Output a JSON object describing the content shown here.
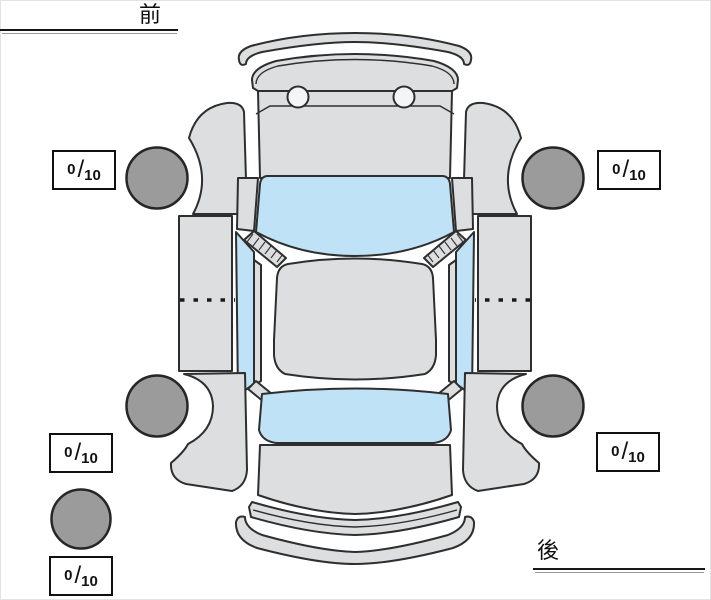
{
  "labels": {
    "front": "前",
    "rear": "後"
  },
  "scores": {
    "separator": "/",
    "front_left": {
      "value": "0",
      "max": "10"
    },
    "front_right": {
      "value": "0",
      "max": "10"
    },
    "rear_left": {
      "value": "0",
      "max": "10"
    },
    "rear_right": {
      "value": "0",
      "max": "10"
    },
    "spare": {
      "value": "0",
      "max": "10"
    }
  },
  "colors": {
    "body": "#dcdedf",
    "window": "#bfe2f6",
    "tire": "#9b9b9b",
    "outline": "#2e2e2e",
    "underline": "#161616",
    "score_border": "#101010",
    "background": "#ffffff"
  },
  "icons": {
    "tire": "tire-circle",
    "spare_tire": "spare-tire-circle"
  }
}
